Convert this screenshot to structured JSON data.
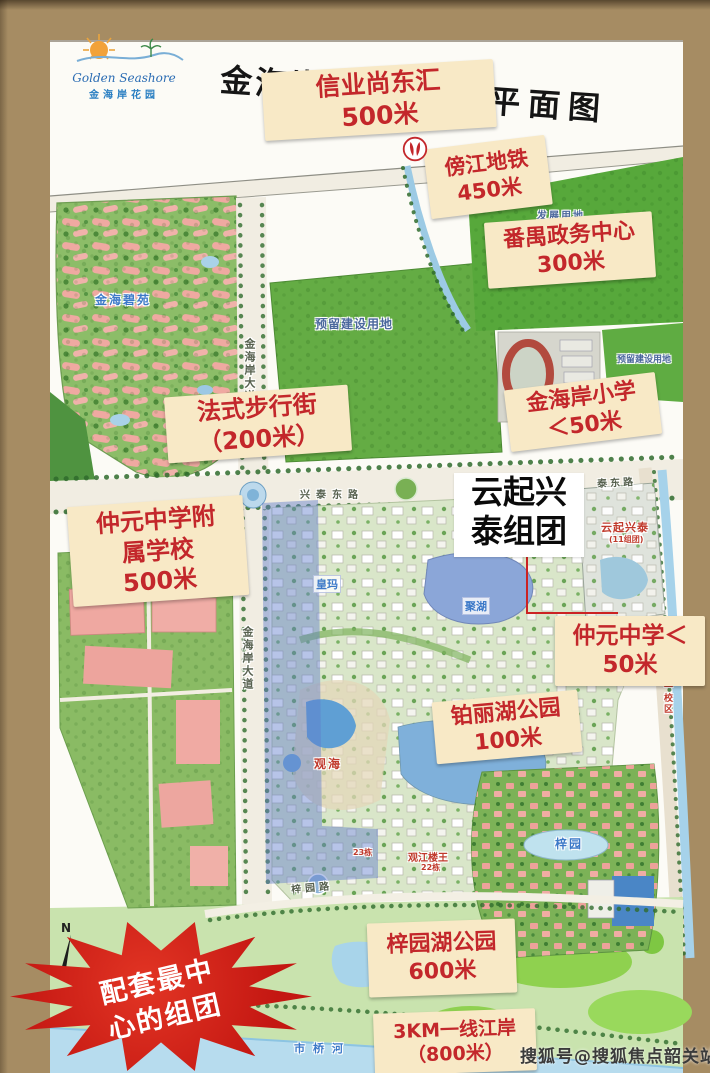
{
  "colors": {
    "label_bg": "#f8e9c6",
    "label_text": "#c3272b",
    "badge_red": "#c41712",
    "frame_brown": "#a68c63"
  },
  "header": {
    "logo_en": "Golden Seashore",
    "logo_cn": "金海岸花园",
    "title_left": "金海岸花",
    "title_right": "平面图"
  },
  "callouts": {
    "xinye": {
      "line1": "信业尚东汇",
      "line2": "500米"
    },
    "metro": {
      "line1": "傍江地铁",
      "line2": "450米"
    },
    "panyu": {
      "line1": "番禺政务中心",
      "line2": "300米"
    },
    "street": {
      "line1": "法式步行街",
      "line2": "（200米）"
    },
    "primary_school": {
      "line1": "金海岸小学",
      "line2": "＜50米"
    },
    "affiliated_school": {
      "line1": "仲元中学附",
      "line2": "属学校",
      "line3": "500米"
    },
    "zhongyuan": {
      "line1": "仲元中学＜",
      "line2": "50米"
    },
    "boli_lake": {
      "line1": "铂丽湖公园",
      "line2": "100米"
    },
    "ziyuan_lake": {
      "line1": "梓园湖公园",
      "line2": "600米"
    },
    "riverside": {
      "line1": "3KM一线江岸",
      "line2": "（800米）"
    }
  },
  "cluster": {
    "line1": "云起兴",
    "line2": "泰组团"
  },
  "badge": {
    "line1": "配套最中",
    "line2": "心的组团"
  },
  "watermark": "搜狐号@搜狐焦点韶关站",
  "compass": "N",
  "map_labels": {
    "jinhai_biyuan": "金海碧苑",
    "reserved_center": "预留建设用地",
    "reserved_right": "预留建设用地",
    "development": "发展用地",
    "xingtai_east_rd": "兴泰东路",
    "taidong_rd": "泰东路",
    "jinhaian_ave_n": "金海岸大道",
    "jinhaian_ave_s": "金海岸大道",
    "huangma": "皇玛",
    "juhu": "聚湖",
    "guanhai": "观海",
    "block23": "23栋",
    "guanjiang_louwang": "观江楼王",
    "block22": "22栋",
    "ziyuan": "梓园",
    "ziyuan_rd": "梓园路",
    "shiqiao_river": "市桥河",
    "yunqi_xingtai": "云起兴泰",
    "yunqi_sub": "(11组团)",
    "school_campus": "一校区"
  }
}
